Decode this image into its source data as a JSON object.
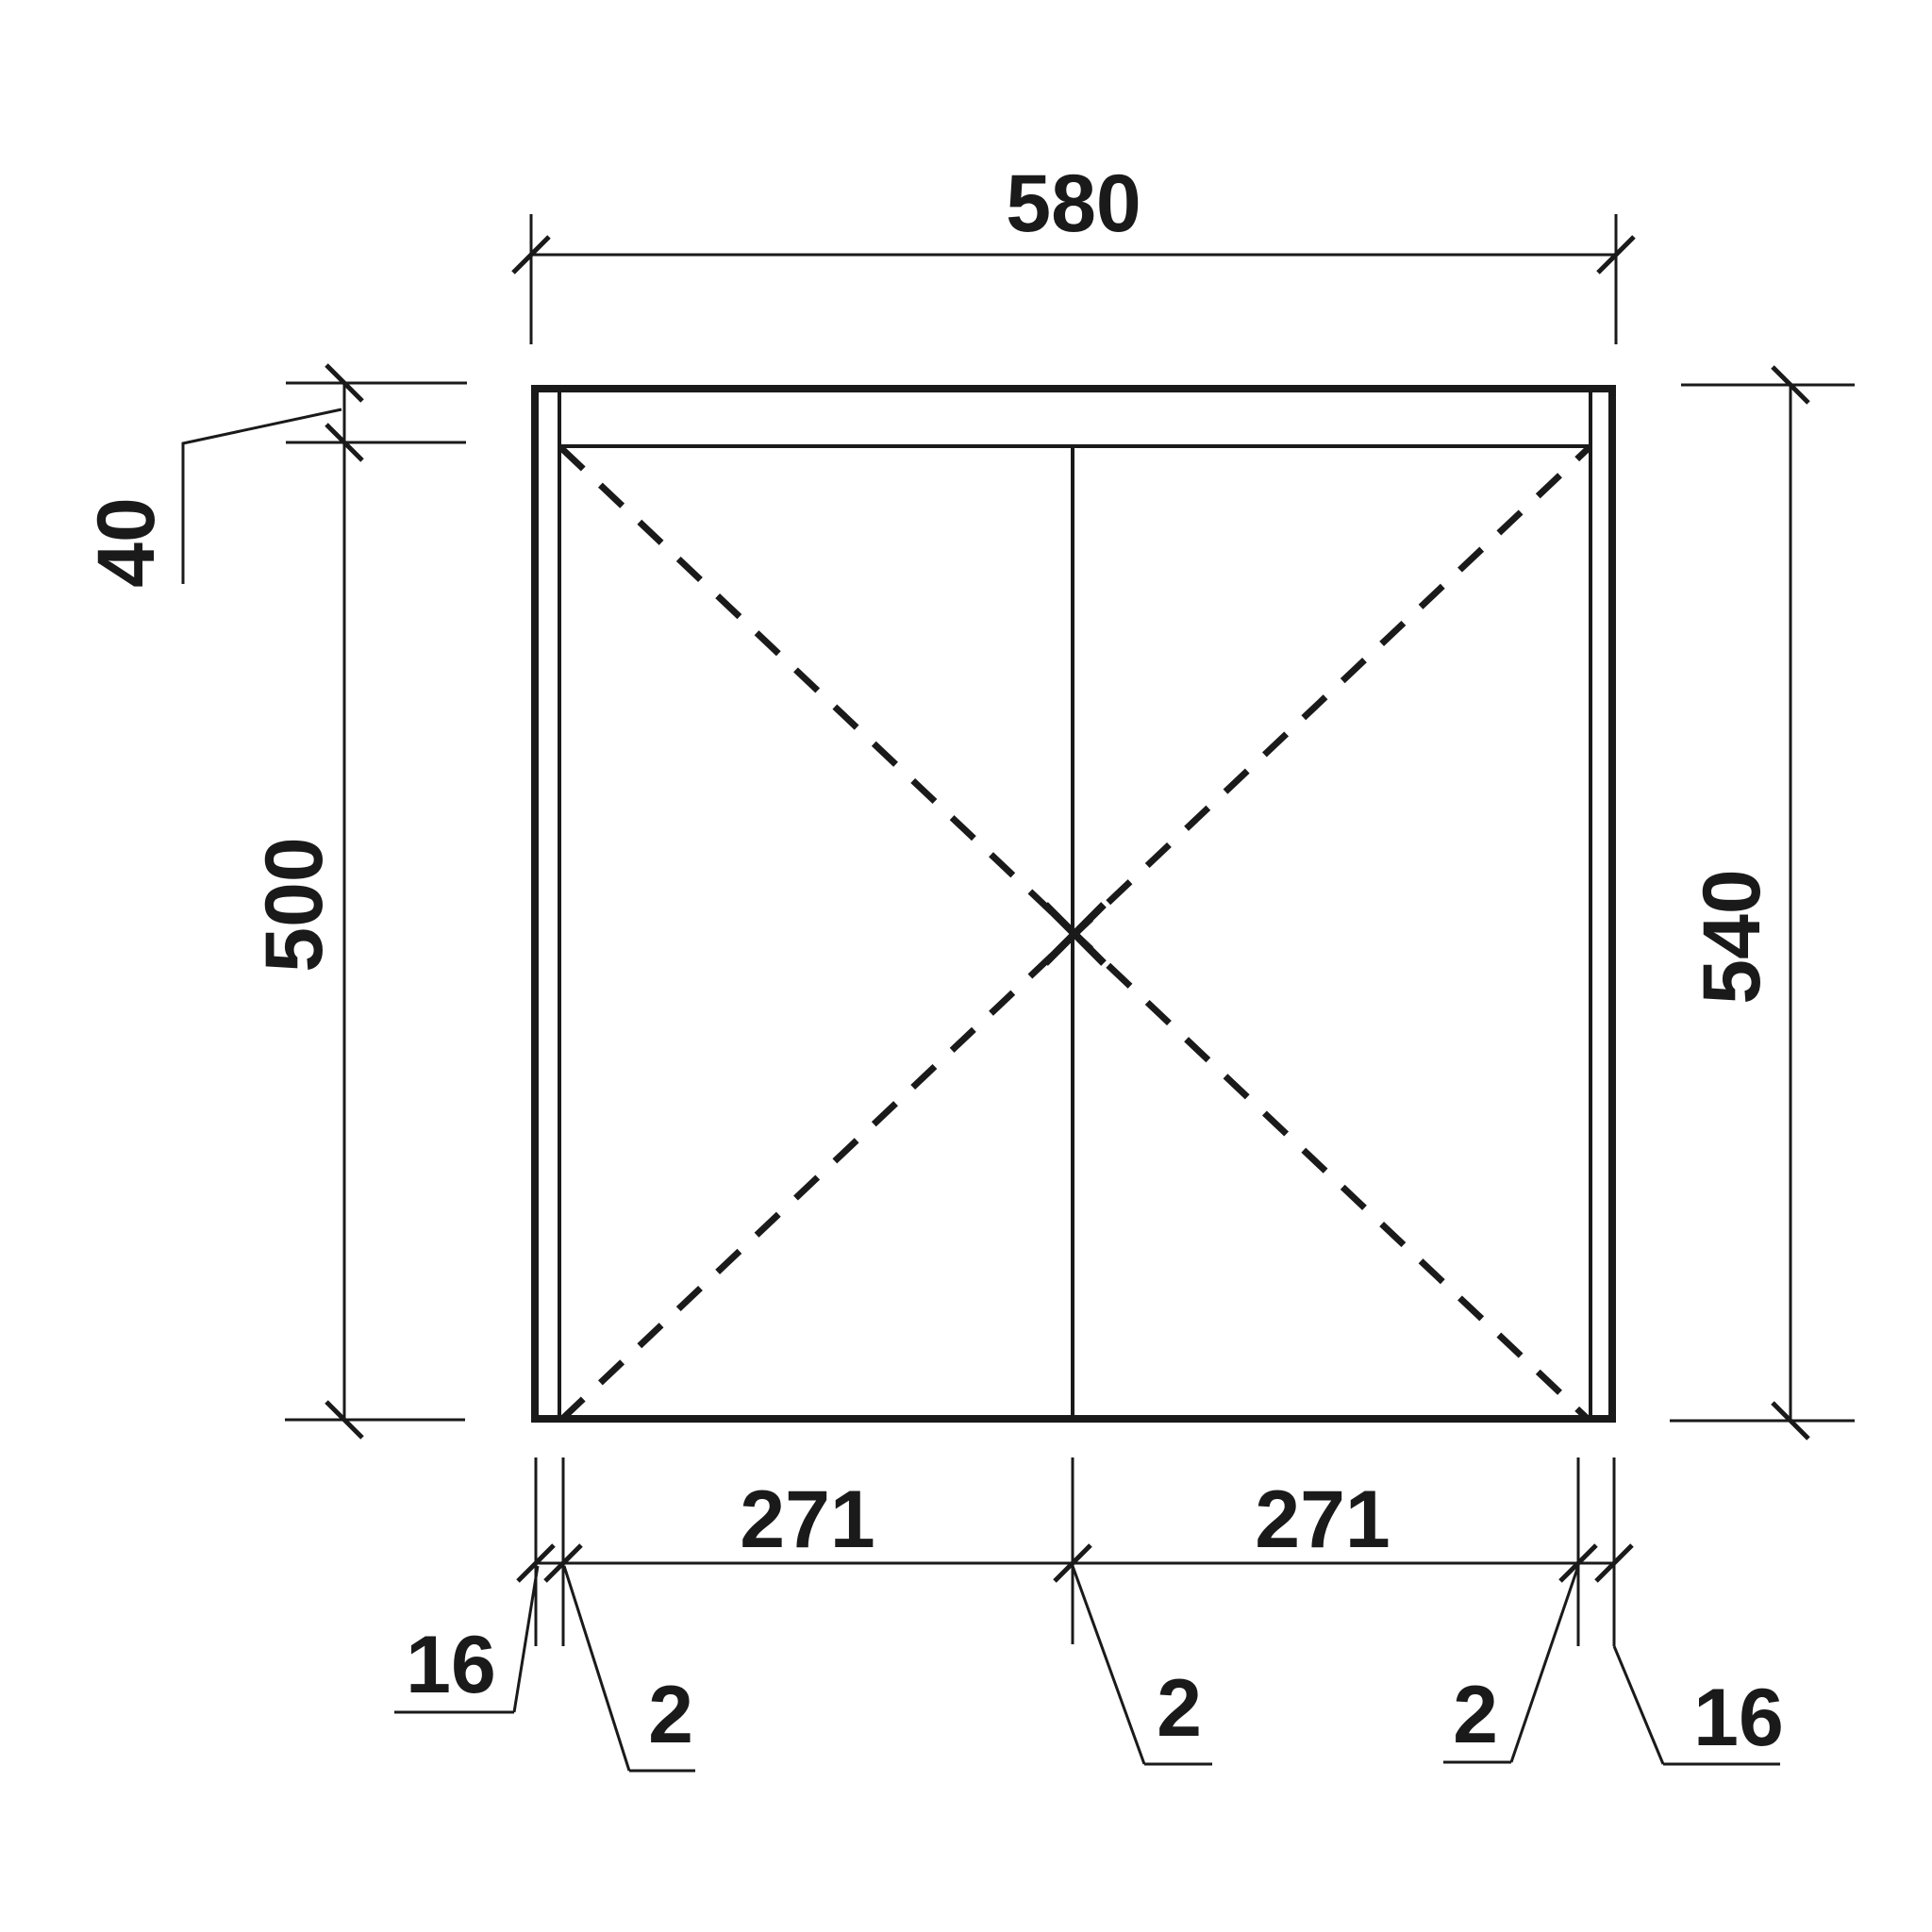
{
  "drawing": {
    "type": "furniture-front-elevation",
    "background_color": "#ffffff",
    "line_color": "#1a1a1a",
    "dimensions": {
      "overall_width": "580",
      "top_rail_height": "40",
      "side_height_below_rail": "500",
      "overall_height": "540",
      "left_door_width": "271",
      "right_door_width": "271",
      "left_side_thickness": "16",
      "left_gap": "2",
      "center_gap": "2",
      "right_gap": "2",
      "right_side_thickness": "16"
    }
  }
}
